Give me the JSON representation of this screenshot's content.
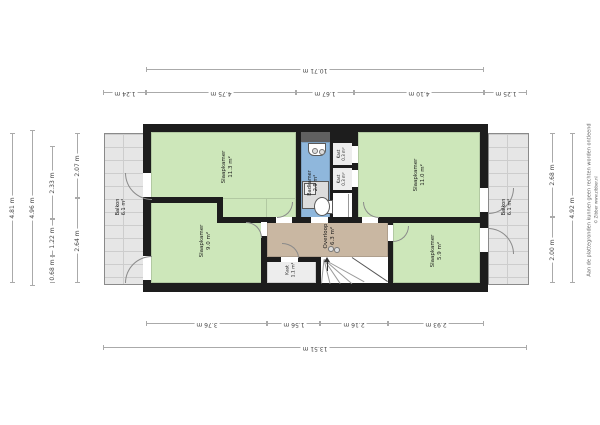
{
  "plan": {
    "rooms": [
      {
        "name": "Slaapkamer",
        "area": "11.3 m²"
      },
      {
        "name": "Slaapkamer",
        "area": "9.0 m²"
      },
      {
        "name": "Slaapkamer",
        "area": "11.0 m²"
      },
      {
        "name": "Slaapkamer",
        "area": "5.9 m²"
      },
      {
        "name": "Badkamer",
        "area": "2.9 m²"
      },
      {
        "name": "Overloop",
        "area": "6.3 m²"
      },
      {
        "name": "Kast",
        "area": "1.1 m²"
      },
      {
        "name": "Kast",
        "area": "0.3 m²"
      },
      {
        "name": "Kast",
        "area": "0.3 m²"
      },
      {
        "name": "Balkon",
        "area": "6.1 m²"
      },
      {
        "name": "Balkon",
        "area": "6.1 m²"
      }
    ],
    "dimensions": {
      "top_total": "10.71 m",
      "top_segments": [
        "1.24 m",
        "4.75 m",
        "1.67 m",
        "4.10 m",
        "1.25 m"
      ],
      "bottom_segments": [
        "3.76 m",
        "1.56 m",
        "2.16 m",
        "2.93 m"
      ],
      "bottom_total": "13.51 m",
      "left_outer": "4.81 m",
      "left_total": "4.96 m",
      "left_segments": [
        "2.33 m",
        "1.22 m",
        "0.68 m"
      ],
      "left_inner": [
        "2.07 m",
        "2.64 m"
      ],
      "right_inner": [
        "2.68 m",
        "2.00 m"
      ],
      "right_total": "4.92 m"
    },
    "disclaimer": {
      "line1": "Aan de plattegronden kunnen geen rechten worden ontleend",
      "line2": "© Zibber www.zibber.nl"
    },
    "colors": {
      "wall": "#1d1d1d",
      "bedroom": "#cde7ba",
      "bathroom": "#8fb7dc",
      "landing": "#c9b7a2",
      "closet": "#ededed",
      "balcony": "#e6e6e6",
      "shaft": "#606060"
    }
  }
}
